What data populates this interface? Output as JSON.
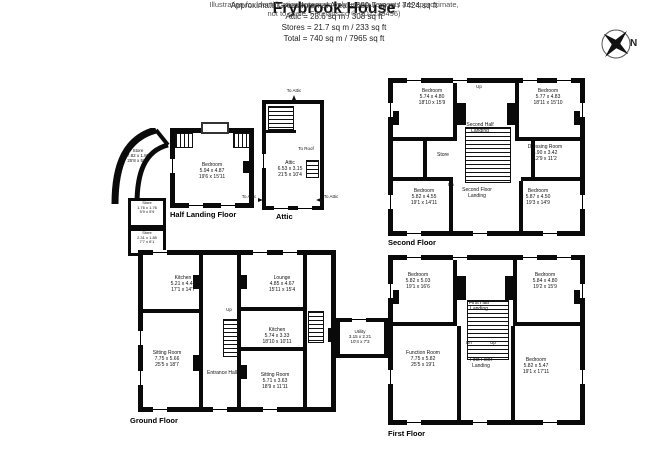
{
  "header": {
    "title": "Frybrook House",
    "area_lines": [
      "Approximate Gross Internal Area = 689.7 sq m / 7424 sq ft",
      "Attic = 28.6 sq m / 308 sq ft",
      "Stores = 21.7 sq m / 233 sq ft",
      "Total = 740 sq m / 7965 sq ft"
    ]
  },
  "compass": {
    "label": "N"
  },
  "misc": {
    "up": "Up",
    "dn": "Dn"
  },
  "floors": {
    "half_landing": {
      "label": "Half Landing Floor",
      "rooms": [
        {
          "name": "Bedroom",
          "m": "5.94 x 4.87",
          "ft": "19'6 x 15'11"
        }
      ]
    },
    "attic": {
      "label": "Attic",
      "rooms": [
        {
          "name": "Attic",
          "m": "6.53 x 3.15",
          "ft": "21'5 x 10'4"
        }
      ],
      "annotations": {
        "to_attic_top": "To Attic",
        "to_roof": "To Roof",
        "to_attic_bl": "To Attic",
        "to_attic_br": "To Attic"
      }
    },
    "second": {
      "label": "Second Floor",
      "rooms": [
        {
          "name": "Bedroom",
          "m": "5.74 x 4.80",
          "ft": "18'10 x 15'9"
        },
        {
          "name": "Bedroom",
          "m": "5.77 x 4.83",
          "ft": "18'11 x 15'10"
        },
        {
          "name": "Second Half Landing",
          "m": "",
          "ft": ""
        },
        {
          "name": "Store",
          "m": "",
          "ft": ""
        },
        {
          "name": "Dressing Room",
          "m": "3.90 x 3.42",
          "ft": "12'9 x 11'2"
        },
        {
          "name": "Bedroom",
          "m": "5.82 x 4.55",
          "ft": "19'1 x 14'11"
        },
        {
          "name": "Second Floor Landing",
          "m": "",
          "ft": ""
        },
        {
          "name": "Bedroom",
          "m": "5.87 x 4.50",
          "ft": "19'3 x 14'9"
        }
      ]
    },
    "first": {
      "label": "First Floor",
      "rooms": [
        {
          "name": "Bedroom",
          "m": "5.82 x 5.03",
          "ft": "19'1 x 16'6"
        },
        {
          "name": "Bedroom",
          "m": "5.84 x 4.80",
          "ft": "19'2 x 15'9"
        },
        {
          "name": "First Half Landing",
          "m": "",
          "ft": ""
        },
        {
          "name": "Function Room",
          "m": "7.75 x 5.82",
          "ft": "25'5 x 19'1"
        },
        {
          "name": "First Floor Landing",
          "m": "",
          "ft": ""
        },
        {
          "name": "Bedroom",
          "m": "5.82 x 5.47",
          "ft": "19'1 x 17'11"
        }
      ]
    },
    "ground": {
      "label": "Ground Floor",
      "rooms": [
        {
          "name": "Store",
          "m": "7.82 x 1.80",
          "ft": "25'8 x 5'11"
        },
        {
          "name": "Store",
          "m": "1.76 x 1.76",
          "ft": "5'9 x 5'9"
        },
        {
          "name": "Store",
          "m": "2.31 x 1.85",
          "ft": "7'7 x 6'1"
        },
        {
          "name": "Kitchen",
          "m": "5.21 x 4.44",
          "ft": "17'1 x 14'7"
        },
        {
          "name": "Sitting Room",
          "m": "7.75 x 5.66",
          "ft": "25'5 x 18'7"
        },
        {
          "name": "Entrance Hall",
          "m": "",
          "ft": ""
        },
        {
          "name": "Lounge",
          "m": "4.85 x 4.67",
          "ft": "15'11 x 15'4"
        },
        {
          "name": "Kitchen",
          "m": "5.74 x 3.33",
          "ft": "18'10 x 10'11"
        },
        {
          "name": "Sitting Room",
          "m": "5.71 x 3.63",
          "ft": "18'9 x 11'11"
        },
        {
          "name": "Utility",
          "m": "3.15 x 2.21",
          "ft": "10'4 x 7'3"
        }
      ]
    }
  },
  "footer": {
    "line1": "Illustration for identification purposes only, measurements are approximate,",
    "line2": "not to scale. Fourlabs.co © (ID1239496)"
  }
}
